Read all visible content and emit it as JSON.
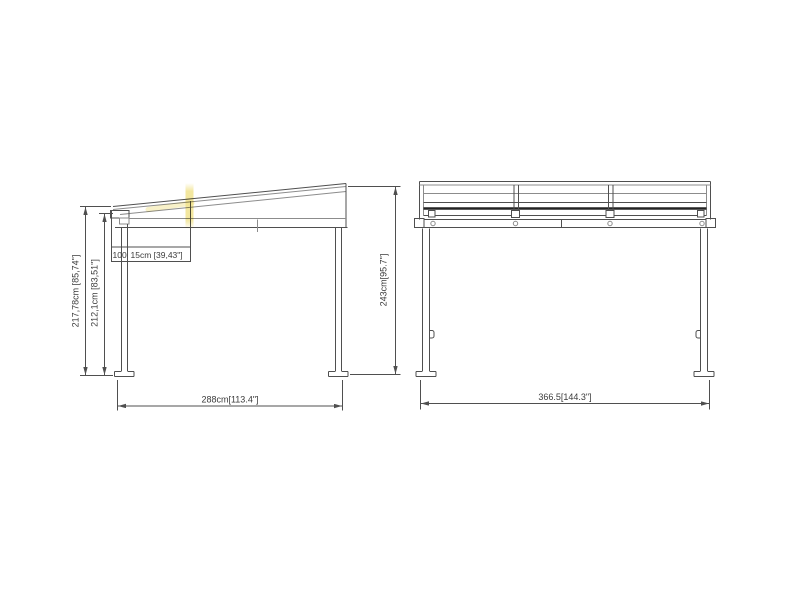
{
  "canvas": {
    "background": "#ffffff",
    "line_color": "#4f4f4f",
    "highlight_color": "#f0e187",
    "text_color": "#3b3b3b"
  },
  "side_view": {
    "dim_height_outer": "217,78cm [85,74\"]",
    "dim_height_inner": "212,1cm [83,51\"]",
    "dim_roof_part1": "100",
    "dim_roof_part2": "15cm [39,43\"]",
    "dim_width": "288cm[113.4\"]",
    "dim_height_right": "243cm[95.7\"]"
  },
  "front_view": {
    "dim_width": "366.5[144.3\"]"
  }
}
